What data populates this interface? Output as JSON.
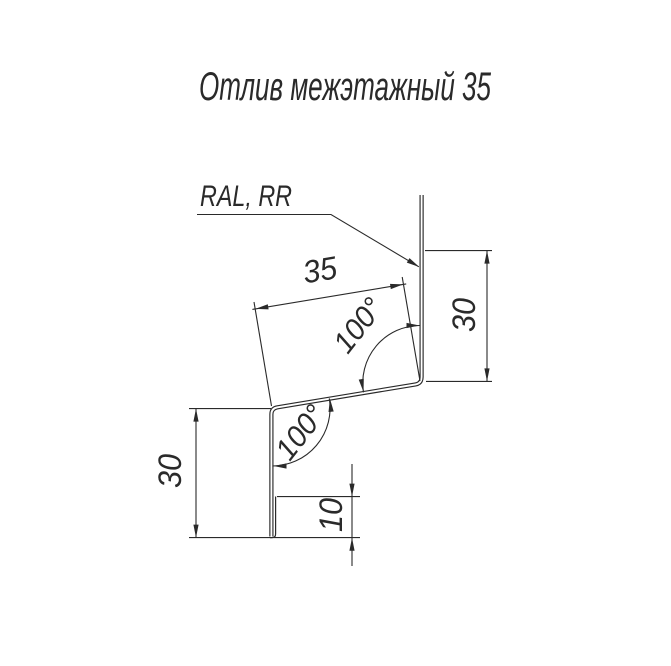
{
  "title": "Отлив межэтажный 35",
  "coating_callout": "RAL, RR",
  "dimensions": {
    "slope_width": "35",
    "right_flange_height": "30",
    "left_flange_height": "30",
    "bottom_hem": "10",
    "upper_bend_angle": "100°",
    "lower_bend_angle": "100°"
  },
  "colors": {
    "line": "#2a2a2a",
    "background": "#ffffff"
  }
}
